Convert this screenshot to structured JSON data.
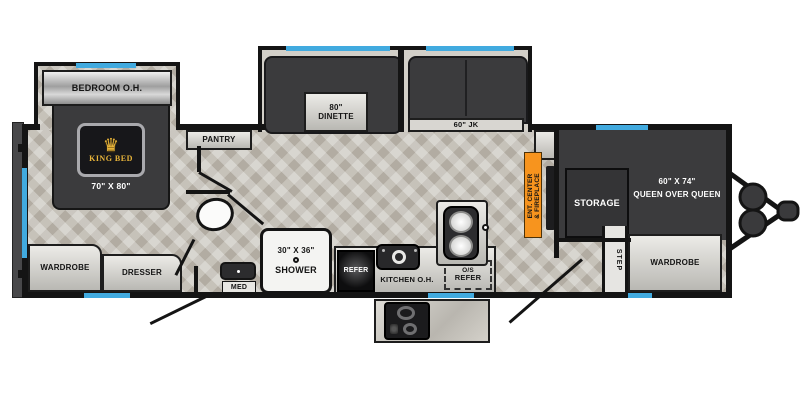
{
  "colors": {
    "wall": "#141414",
    "window": "#41aadf",
    "accent_orange": "#f7941e",
    "furniture_dark": "#3b3b3d",
    "cabinet_light": "#dddcd8",
    "floor": "#c6c2b9",
    "badge_gold": "#e8b43a"
  },
  "rear_bedroom": {
    "overhead_label": "BEDROOM O.H.",
    "bed_badge_label": "KING BED",
    "bed_size_label": "70\" X 80\"",
    "wardrobe_label": "WARDROBE",
    "dresser_label": "DRESSER"
  },
  "bathroom": {
    "shower_size_label": "30\" X 36\"",
    "shower_label": "SHOWER",
    "med_label": "MED"
  },
  "galley": {
    "pantry_label": "PANTRY",
    "refer_label": "REFER",
    "kitchen_overhead_label": "KITCHEN O.H.",
    "outside_refer_line1": "O/S",
    "outside_refer_line2": "REFER"
  },
  "living_area": {
    "dinette_size_label": "80\"",
    "dinette_label": "DINETTE",
    "sofa_label": "60\" JK",
    "ent_center_line1": "ENT. CENTER",
    "ent_center_line2": "& FIREPLACE"
  },
  "front_bedroom": {
    "storage_label": "STORAGE",
    "bunk_size_label": "60\" X 74\"",
    "bunk_label": "QUEEN OVER QUEEN",
    "step_label": "STEP",
    "wardrobe_label": "WARDROBE"
  },
  "icons": {
    "crown_glyph": "♛"
  }
}
